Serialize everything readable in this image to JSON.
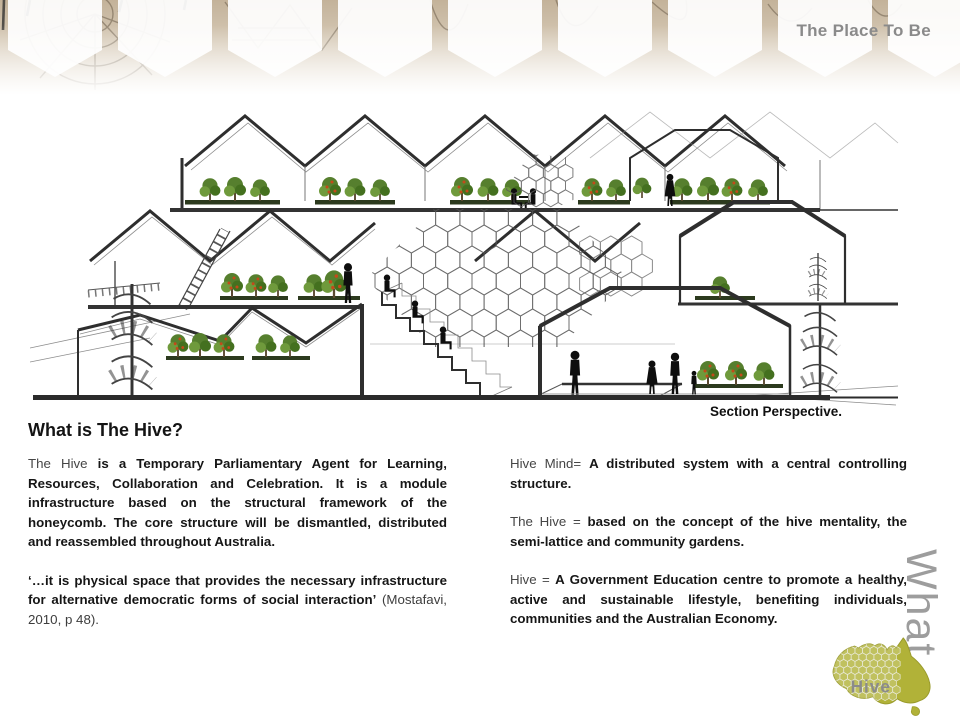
{
  "slide": {
    "brand": "The Place To Be",
    "heading": "What is The Hive?",
    "drawing_caption": "Section Perspective.",
    "vertical_label": "What",
    "map_label": "Hive",
    "left": {
      "p1_lead": "The Hive ",
      "p1_body": "is a Temporary Parliamentary Agent for Learning, Resources, Collaboration and Celebration.  It is a module infrastructure  based on the structural framework of the honeycomb. The core structure will be dismantled, distributed and reassembled throughout Australia.",
      "p2_quote": "‘…it is physical space that provides the necessary infrastructure for alternative democratic forms of social interaction’",
      "p2_cite": " (Mostafavi, 2010, p 48)."
    },
    "right": {
      "p1_lead": "Hive Mind=  ",
      "p1_body": "A distributed system with a central controlling structure.",
      "p2_lead": "The Hive =  ",
      "p2_body": "based on the concept of the hive mentality, the semi-lattice and  community gardens.",
      "p3_lead": "Hive =  ",
      "p3_body": "A Government Education centre to promote a healthy, active and sustainable lifestyle, benefiting individuals, communities and the Australian Economy."
    },
    "colors": {
      "accent_olive": "#b1b238",
      "banner_tan": "#c8b9a2",
      "text_dark": "#161616",
      "muted_gray": "#8a8a8a",
      "tree_green": "#567f2e",
      "fruit_red": "#c44a1a"
    }
  }
}
